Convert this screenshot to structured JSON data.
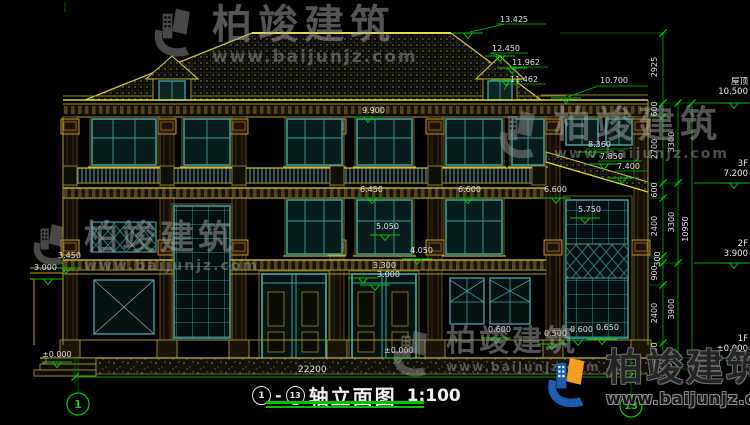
{
  "watermark": {
    "brand": "柏竣建筑",
    "url": "www.baijunjz.com"
  },
  "title_block": {
    "axis_start": "1",
    "separator": "-",
    "axis_end": "13",
    "title": "轴立面图",
    "scale": "1:100",
    "total_width": "22200"
  },
  "elevations": {
    "ridge": "13.425",
    "dormer_ridge": "12.450",
    "dormer_eave": "11.962",
    "dormer_sill": "11.462",
    "main_eave": "10.700",
    "f3_head": "9.900",
    "wing_ridge": "8.360",
    "wing_mid": "7.850",
    "wing_eave": "7.400",
    "balcony_center": "6.450",
    "balcony_right_a": "6.600",
    "balcony_right_b": "6.600",
    "wing_sill": "5.750",
    "f2_sill": "5.050",
    "f2_lower": "4.050",
    "door_head_a": "3.300",
    "door_head_b": "3.000",
    "porch_top": "3.450",
    "porch_level": "3.000",
    "plinth_a": "0.600",
    "plinth_b": "0.500",
    "plinth_c": "0.600",
    "plinth_d": "0.650",
    "ground_center": "±0.000",
    "ground_left": "±0.000"
  },
  "right_dim_chain": {
    "segments": [
      "2925",
      "600",
      "2700",
      "600",
      "2400",
      "300",
      "900",
      "2400",
      "600",
      "450",
      "450"
    ],
    "floor_heights": [
      "3300",
      "3300",
      "3900"
    ],
    "total": "10950"
  },
  "floor_levels": [
    {
      "name": "屋顶",
      "value": "10.500"
    },
    {
      "name": "3F",
      "value": "7.200"
    },
    {
      "name": "2F",
      "value": "3.900"
    },
    {
      "name": "1F",
      "value": "±0.000"
    }
  ]
}
